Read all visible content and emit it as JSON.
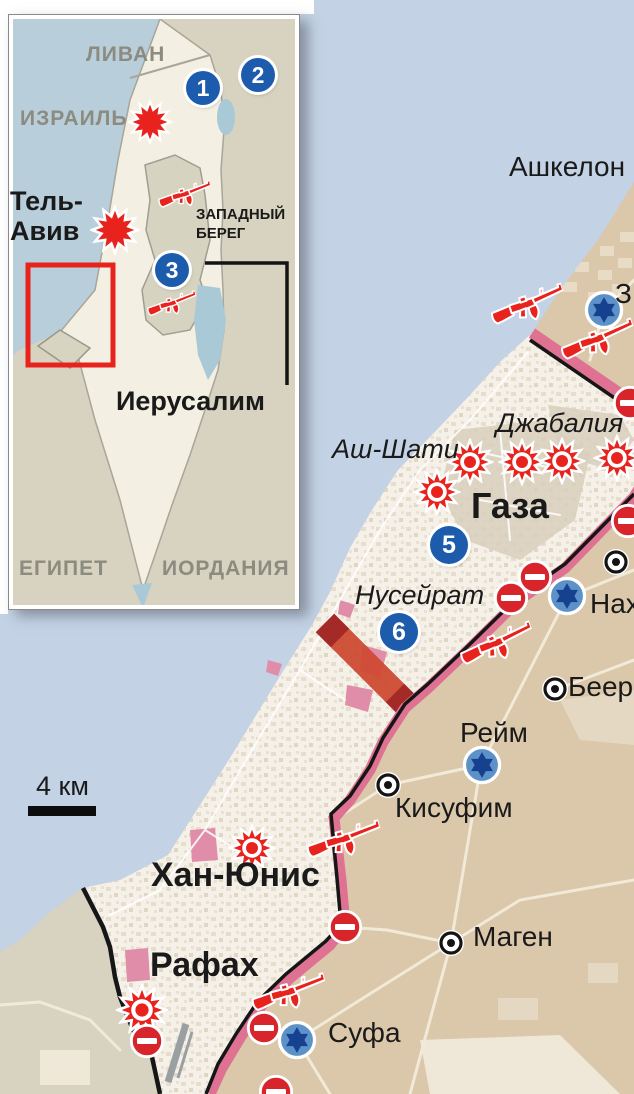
{
  "inset": {
    "labels": {
      "lebanon": "ЛИВАН",
      "israel": "ИЗРАИЛЬ",
      "tel_aviv_line1": "Тель-",
      "tel_aviv_line2": "Авив",
      "west_bank_line1": "ЗАПАДНЫЙ",
      "west_bank_line2": "БЕРЕГ",
      "jerusalem": "Иерусалим",
      "egypt": "ЕГИПЕТ",
      "jordan": "ИОРДАНИЯ"
    },
    "markers": {
      "m1": "1",
      "m2": "2",
      "m3": "3"
    }
  },
  "main": {
    "labels": {
      "ashkelon": "Ашкелон",
      "z_cut": "З",
      "jabalia": "Джабалия",
      "ash_shati": "Аш-Шати",
      "gaza": "Газа",
      "nuseirat": "Нусейрат",
      "nah_cut": "Нах",
      "beer_cut": "Беер",
      "reim": "Рейм",
      "kisufim": "Кисуфим",
      "khan_yunis": "Хан-Юнис",
      "magen": "Маген",
      "rafah": "Рафах",
      "sufa": "Суфа"
    },
    "markers": {
      "m5": "5",
      "m6": "6"
    },
    "scale": {
      "label": "4 км"
    }
  },
  "icons": {
    "rifle": "red-rifle",
    "burst": "explosion-burst",
    "no_entry": "no-entry-sign",
    "star_of_david": "settlement-star",
    "town_dot": "town-dot",
    "number_marker": "numbered-circle"
  },
  "colors": {
    "sea": "#c4d2e6",
    "inset_sea": "#b9cedb",
    "land": "#dbc7aa",
    "neutral": "#d7d3c0",
    "strip": "#f5f1e9",
    "urban": "#d8cfbc",
    "pink": "#e08da9",
    "rose": "#df7292",
    "corridor": "#ce4a33",
    "corridor_end": "#a42a28",
    "red": "#e8231d",
    "noentry": "#d8242b",
    "marker_blue": "#1d5cad",
    "star_fill": "#5d92c9",
    "star_symbol": "#16418f",
    "label_dark": "#1a1a1a",
    "label_gray": "#8b8b7f",
    "runway": "#9aa0a2"
  }
}
